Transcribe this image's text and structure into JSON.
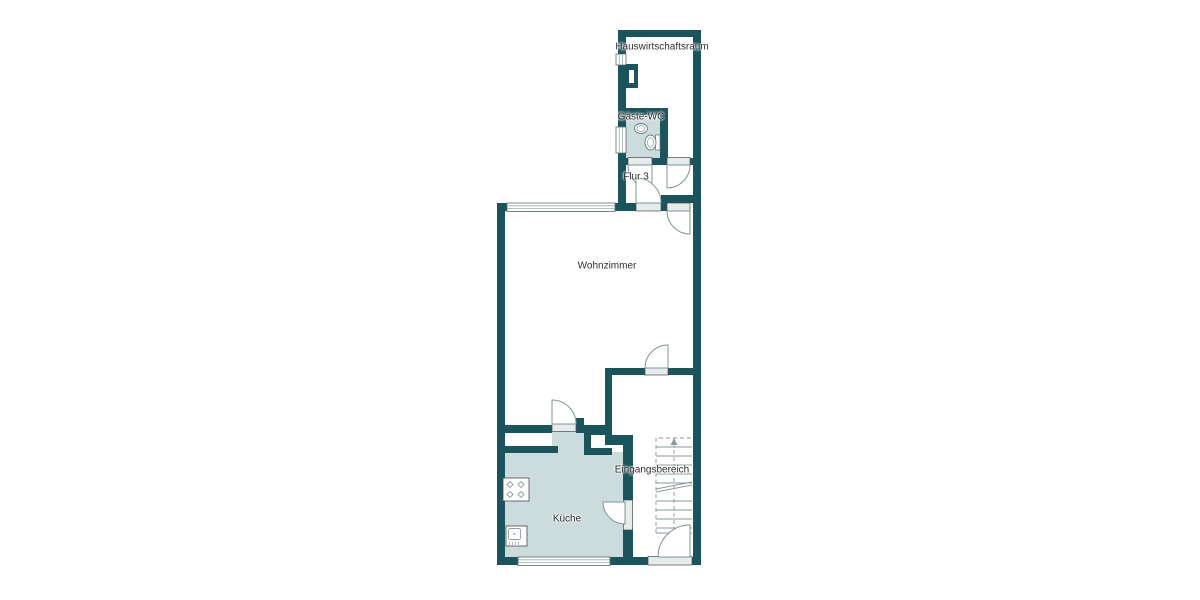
{
  "plan": {
    "type": "floorplan",
    "rooms": {
      "hauswirtschaftsraum": {
        "label": "Hauswirtschaftsraum"
      },
      "gaeste_wc": {
        "label": "Gäste-WC"
      },
      "flur": {
        "label": "Flur 3"
      },
      "wohnzimmer": {
        "label": "Wohnzimmer"
      },
      "eingangsbereich": {
        "label": "Eingangsbereich"
      },
      "kueche": {
        "label": "Küche"
      }
    },
    "fixtures": [
      "staircase",
      "entry-door",
      "stove",
      "kitchen-sink",
      "washbasin",
      "toilet",
      "chimney-shaft"
    ]
  },
  "colors": {
    "wall": "#1a545c",
    "floor_tinted": "#ccdcdd",
    "floor_plain": "#ffffff",
    "sill": "#e6ecec",
    "door_line": "#7f9496",
    "stair_line": "#8b9a9b",
    "window_frame": "#5a6b6d",
    "window_glass": "#9aabad",
    "fixture_line": "#6b7e80",
    "text": "#2f2f2f",
    "background": "#ffffff"
  }
}
